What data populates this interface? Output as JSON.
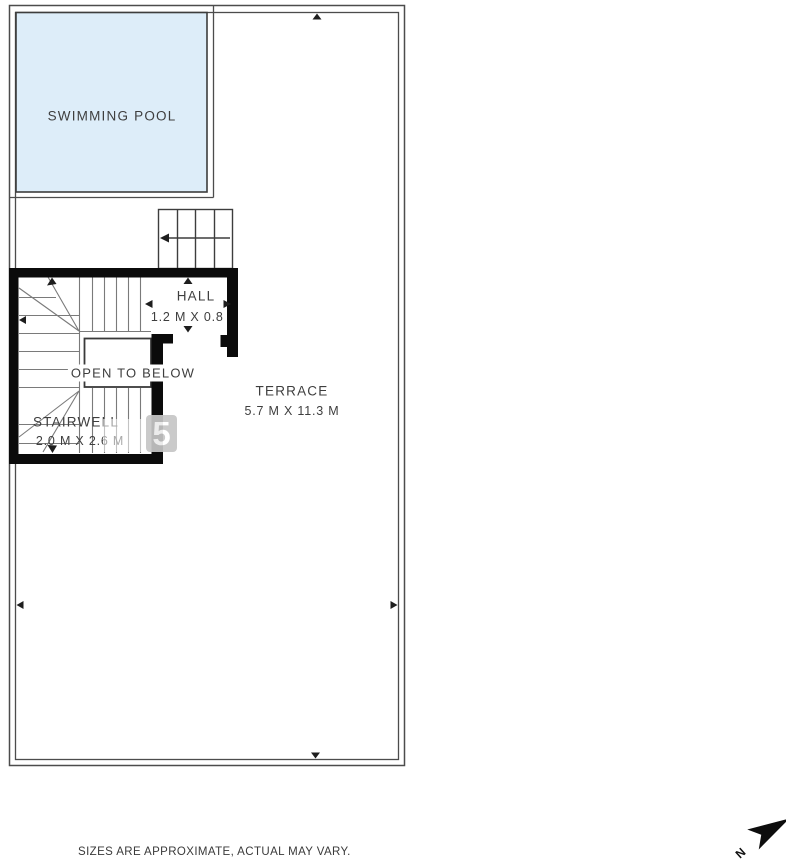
{
  "colors": {
    "pool_fill": "#ddedf9",
    "wall": "#0b0b0b",
    "line": "#4c4c4c",
    "stair_line": "#7a7a7a",
    "detail_line": "#3d3d3d",
    "text": "#3e3e3e",
    "watermark_tile": "#c6c6c6"
  },
  "rooms": {
    "swimming_pool": {
      "label": "SWIMMING POOL"
    },
    "hall": {
      "label": "HALL",
      "dimensions": "1.2 M X 0.8 M"
    },
    "open_to_below": {
      "label": "OPEN TO BELOW"
    },
    "stairwell": {
      "label": "STAIRWELL",
      "dimensions": "2.0 M X 2.6 M"
    },
    "terrace": {
      "label": "TERRACE",
      "dimensions": "5.7 M X 11.3 M"
    }
  },
  "watermark": {
    "text": "5"
  },
  "compass": {
    "north_label": "N"
  },
  "footer": {
    "disclaimer": "SIZES ARE APPROXIMATE, ACTUAL MAY VARY."
  }
}
